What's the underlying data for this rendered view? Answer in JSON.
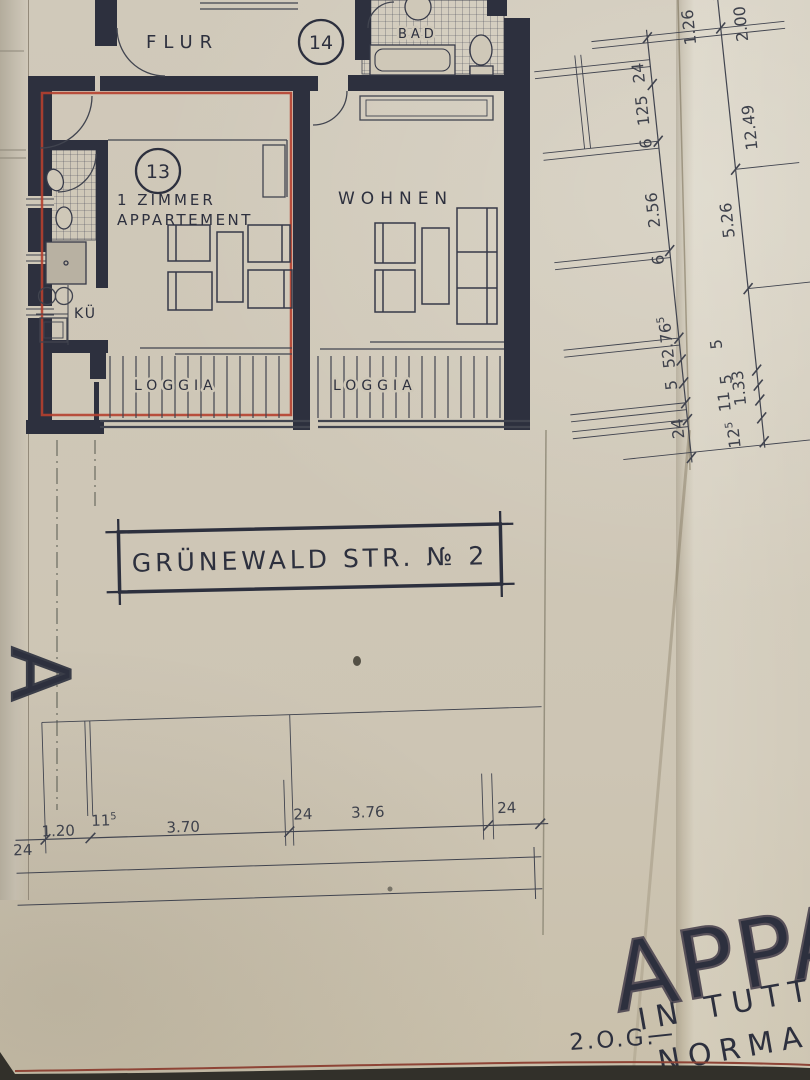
{
  "colors": {
    "paper": "#cfc8b8",
    "ink": "#2d303e",
    "red_boundary": "#b5402f",
    "thin_line": "#41444f",
    "background": "#35342d"
  },
  "plan": {
    "room_labels": {
      "flur": "FLUR",
      "bad": "BAD",
      "apartment_line1": "1 ZIMMER",
      "apartment_line2": "APPARTEMENT",
      "wohnen": "WOHNEN",
      "kitchen": "KÜ",
      "loggia_left": "LOGGIA",
      "loggia_right": "LOGGIA"
    },
    "unit_circles": {
      "unit13": "13",
      "unit14": "14"
    }
  },
  "title_box": {
    "text": "GRÜNEWALD STR. № 2"
  },
  "dims": {
    "right": [
      {
        "t": "24"
      },
      {
        "t": "125"
      },
      {
        "t": "6"
      },
      {
        "t": "2.56"
      },
      {
        "t": "6"
      },
      {
        "t": "2.76",
        "s": "5"
      },
      {
        "t": "5"
      },
      {
        "t": "5"
      },
      {
        "t": "24"
      },
      {
        "t": "1.26"
      },
      {
        "t": "2.00"
      },
      {
        "t": "12.49"
      },
      {
        "t": "5.26"
      },
      {
        "t": "5"
      },
      {
        "t": "5"
      },
      {
        "t": "1.33"
      },
      {
        "t": "11"
      },
      {
        "t": "12",
        "s": "5"
      }
    ],
    "bottom": [
      {
        "t": "24"
      },
      {
        "t": "1.20"
      },
      {
        "t": "11",
        "s": "5"
      },
      {
        "t": "3.70"
      },
      {
        "t": "24"
      },
      {
        "t": "3.76"
      },
      {
        "t": "24"
      }
    ]
  },
  "footer": {
    "headline": "APPA",
    "line2": "IN TUTT",
    "line3": "NORMAL",
    "floor_label": "2.O.G.",
    "dash": "—"
  },
  "margin_letter": "A"
}
